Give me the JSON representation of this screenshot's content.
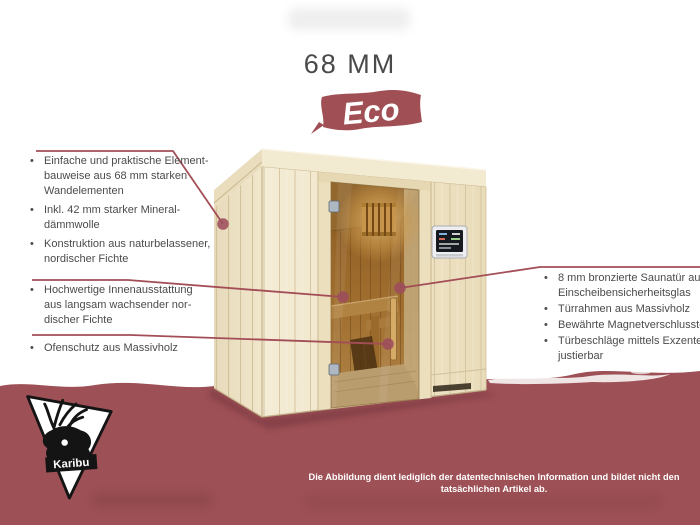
{
  "title": "68 MM",
  "badge": {
    "label": "Eco"
  },
  "brand": {
    "name": "Karibu"
  },
  "colors": {
    "maroon_band": "#9d5055",
    "leader_line": "#a34e57",
    "badge_maroon": "#a04f54",
    "body_text": "#4b4b4b",
    "title_text": "#4b494b",
    "wood_light": "#f0e6cb",
    "wood_interior": "#b9853d"
  },
  "bullets": {
    "left_top": [
      {
        "lines": [
          "Einfache und praktische Element-",
          "bauweise aus 68 mm starken",
          "Wandelementen"
        ]
      },
      {
        "lines": [
          "Inkl. 42 mm starker Mineral-",
          "dämmwolle"
        ]
      },
      {
        "lines": [
          "Konstruktion aus naturbelassener,",
          "nordischer Fichte"
        ]
      }
    ],
    "left_mid": [
      {
        "lines": [
          "Hochwertige Innenausstattung",
          "aus langsam wachsender nor-",
          "discher Fichte"
        ]
      }
    ],
    "left_bottom": [
      {
        "lines": [
          "Ofenschutz aus Massivholz"
        ]
      }
    ],
    "right": [
      {
        "lines": [
          "8 mm bronzierte Saunatür aus",
          "Einscheibensicherheitsglas"
        ]
      },
      {
        "lines": [
          "Türrahmen aus Massivholz"
        ]
      },
      {
        "lines": [
          "Bewährte Magnetverschlusstechnik"
        ]
      },
      {
        "lines": [
          "Türbeschläge mittels Exzenter",
          "justierbar"
        ]
      }
    ]
  },
  "footer": {
    "disclaimer": "Die Abbildung dient lediglich der datentechnischen Information und bildet nicht den tatsächlichen Artikel ab."
  }
}
